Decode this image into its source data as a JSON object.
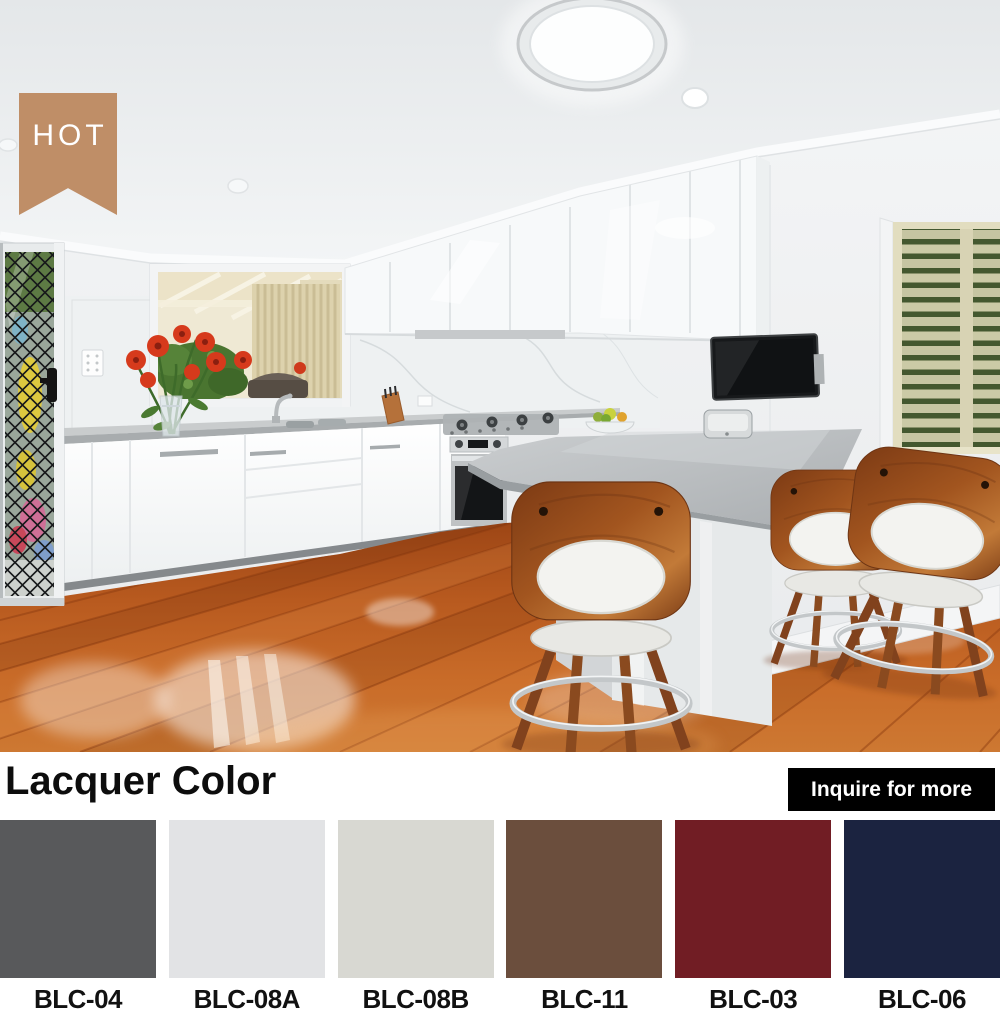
{
  "badge": {
    "label": "HOT",
    "bg_color": "#bd8b63",
    "text_color": "#ffffff"
  },
  "lacquer_section": {
    "title": "Lacquer Color",
    "inquire_button_label": "Inquire for more",
    "button_bg": "#000000",
    "button_text_color": "#ffffff",
    "swatches": [
      {
        "code": "BLC-04",
        "color": "#58595b"
      },
      {
        "code": "BLC-08A",
        "color": "#e2e3e5"
      },
      {
        "code": "BLC-08B",
        "color": "#d8d8d2"
      },
      {
        "code": "BLC-11",
        "color": "#6b4e3d"
      },
      {
        "code": "BLC-03",
        "color": "#711d24"
      },
      {
        "code": "BLC-06",
        "color": "#1b2340"
      }
    ]
  }
}
